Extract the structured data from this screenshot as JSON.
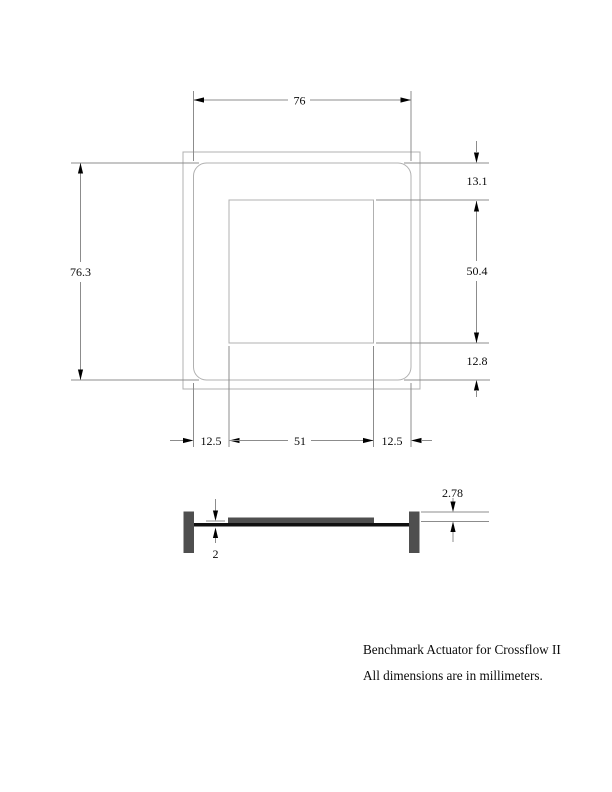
{
  "top_view": {
    "dims": {
      "overall_width": "76",
      "overall_height": "76.3",
      "top_offset": "13.1",
      "cavity_height": "50.4",
      "bottom_offset": "12.8",
      "left_margin": "12.5",
      "cavity_width": "51",
      "right_margin": "12.5"
    }
  },
  "section_view": {
    "dims": {
      "plate_thickness": "2",
      "stack_height": "2.78"
    }
  },
  "notes": {
    "line1": "Benchmark Actuator for Crossflow II",
    "line2": "All dimensions are in millimeters."
  },
  "colors": {
    "background": "#ffffff",
    "outline": "#b0b0b0",
    "dimension_line": "#8c8c8c",
    "ink": "#000000",
    "solid_fill": "#4f4f4f",
    "membrane_fill": "#101010"
  }
}
